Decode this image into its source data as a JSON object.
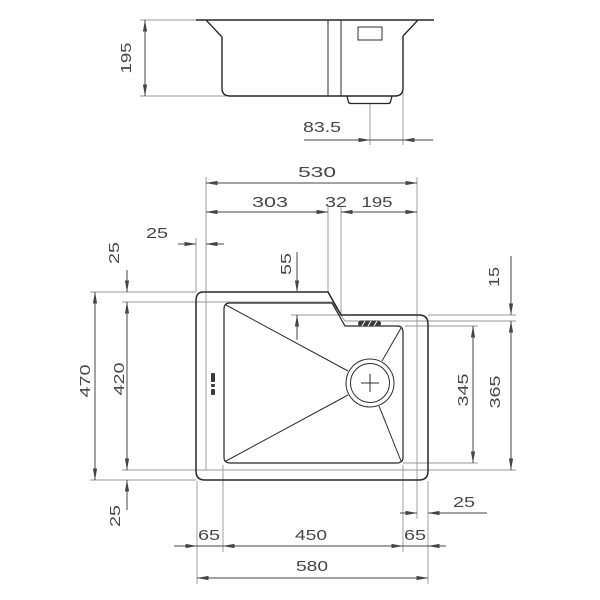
{
  "drawing": {
    "type": "sink-technical-drawing",
    "colors": {
      "primary_line": "#262626",
      "secondary_line": "#979797",
      "dimension_line": "#454545",
      "text": "#474747",
      "background": "#ffffff"
    },
    "side_view": {
      "dims": {
        "depth": "195",
        "drain_to_wall": "83.5"
      }
    },
    "top_view": {
      "dims": {
        "cutout_width": "530",
        "cutout_left": "303",
        "cutout_step": "32",
        "cutout_right": "195",
        "offset_top_h": "25",
        "offset_top_v": "25",
        "overall_depth": "470",
        "cutout_depth": "420",
        "offset_bottom": "25",
        "step_depth": "55",
        "ledge_offset": "15",
        "bowl_depth": "345",
        "ledge_cutout_depth": "365",
        "offset_right": "25",
        "margin_left": "65",
        "bowl_width": "450",
        "margin_right": "65",
        "overall_width": "580"
      }
    }
  }
}
